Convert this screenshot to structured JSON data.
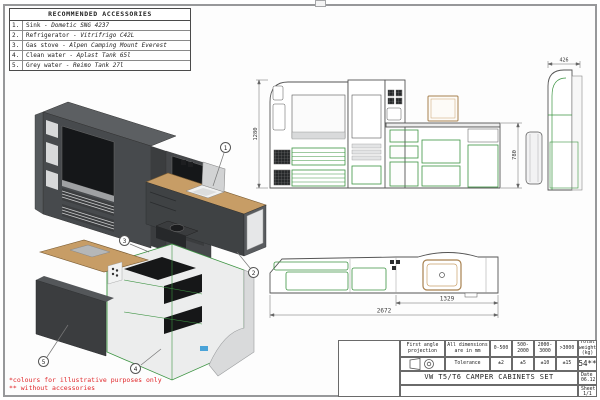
{
  "accessories": {
    "title": "RECOMMENDED ACCESSORIES",
    "rows": [
      {
        "num": "1.",
        "label": "Sink - ",
        "product": "Dometic SNG 4237"
      },
      {
        "num": "2.",
        "label": "Refrigerator - ",
        "product": "Vitrifrigo C42L"
      },
      {
        "num": "3.",
        "label": "Gas stove - ",
        "product": "Alpen Camping Mount Everest"
      },
      {
        "num": "4.",
        "label": "Clean water - ",
        "product": "Aplast Tank 65l"
      },
      {
        "num": "5.",
        "label": "Grey water - ",
        "product": "Reimo Tank 27l"
      }
    ]
  },
  "dimensions": {
    "front_height": "1280",
    "counter_height": "780",
    "side_depth": "426",
    "counter_length": "1329",
    "total_length": "2672"
  },
  "balloons": [
    "1",
    "2",
    "3",
    "4",
    "5"
  ],
  "notes": {
    "colours": "*colours for illustrative purposes only",
    "accessories": "** without accessories"
  },
  "title_block": {
    "projection_label": "First angle projection",
    "dims_label": "All dimensions are in mm",
    "tolerance_label": "Tolerance",
    "ranges": [
      "0-500",
      "500-2000",
      "2000-3000",
      ">3000"
    ],
    "tolerances": [
      "±2",
      "±5",
      "±10",
      "±15"
    ],
    "weight_label": "Total weight (kg)",
    "weight_value": "54**",
    "title": "VW T5/T6 CAMPER CABINETS SET",
    "date_label": "Date",
    "date_value": "06.12.2023",
    "sheet_label": "Sheet",
    "sheet_value": "1/1"
  },
  "colors": {
    "accent_green": "#3c9442",
    "wood": "#c79d66",
    "dark_cabinet": "#46484b",
    "note_red": "#e02427"
  }
}
